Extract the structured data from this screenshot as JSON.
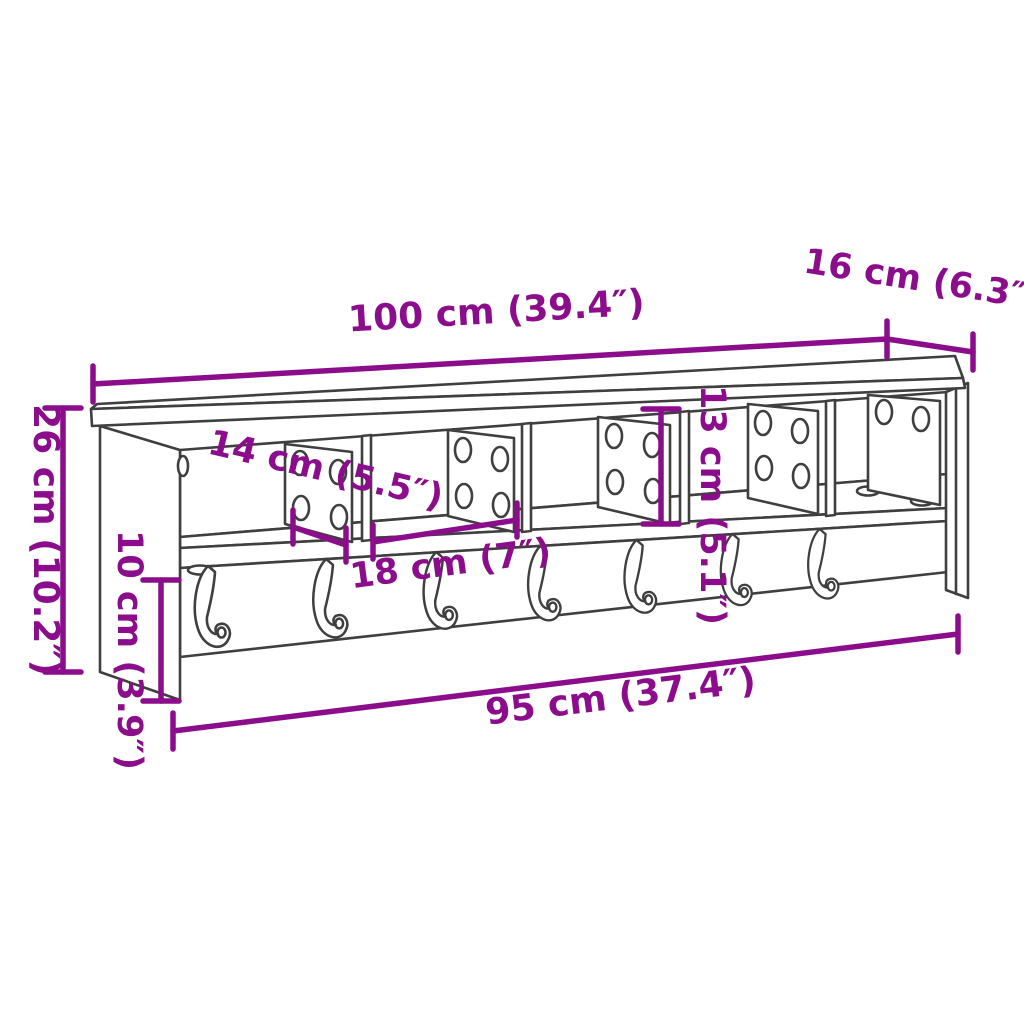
{
  "diagram": {
    "subject": "wall-mounted coat rack with compartments and hooks",
    "colors": {
      "dimension_annotation": "#8B0D8B",
      "furniture_outline": "#3F3F3F",
      "background": "#FFFFFF"
    },
    "features": {
      "compartments": 5,
      "hooks": 7
    },
    "dimensions": {
      "total_width": "100 cm (39.4″)",
      "total_depth": "16 cm (6.3″)",
      "total_height": "26 cm (10.2″)",
      "compartment_depth": "14 cm (5.5″)",
      "compartment_height": "13 cm (5.1″)",
      "compartment_width": "18 cm (7″)",
      "lower_section_height": "10 cm (3.9″)",
      "bottom_width": "95 cm (37.4″)"
    }
  }
}
